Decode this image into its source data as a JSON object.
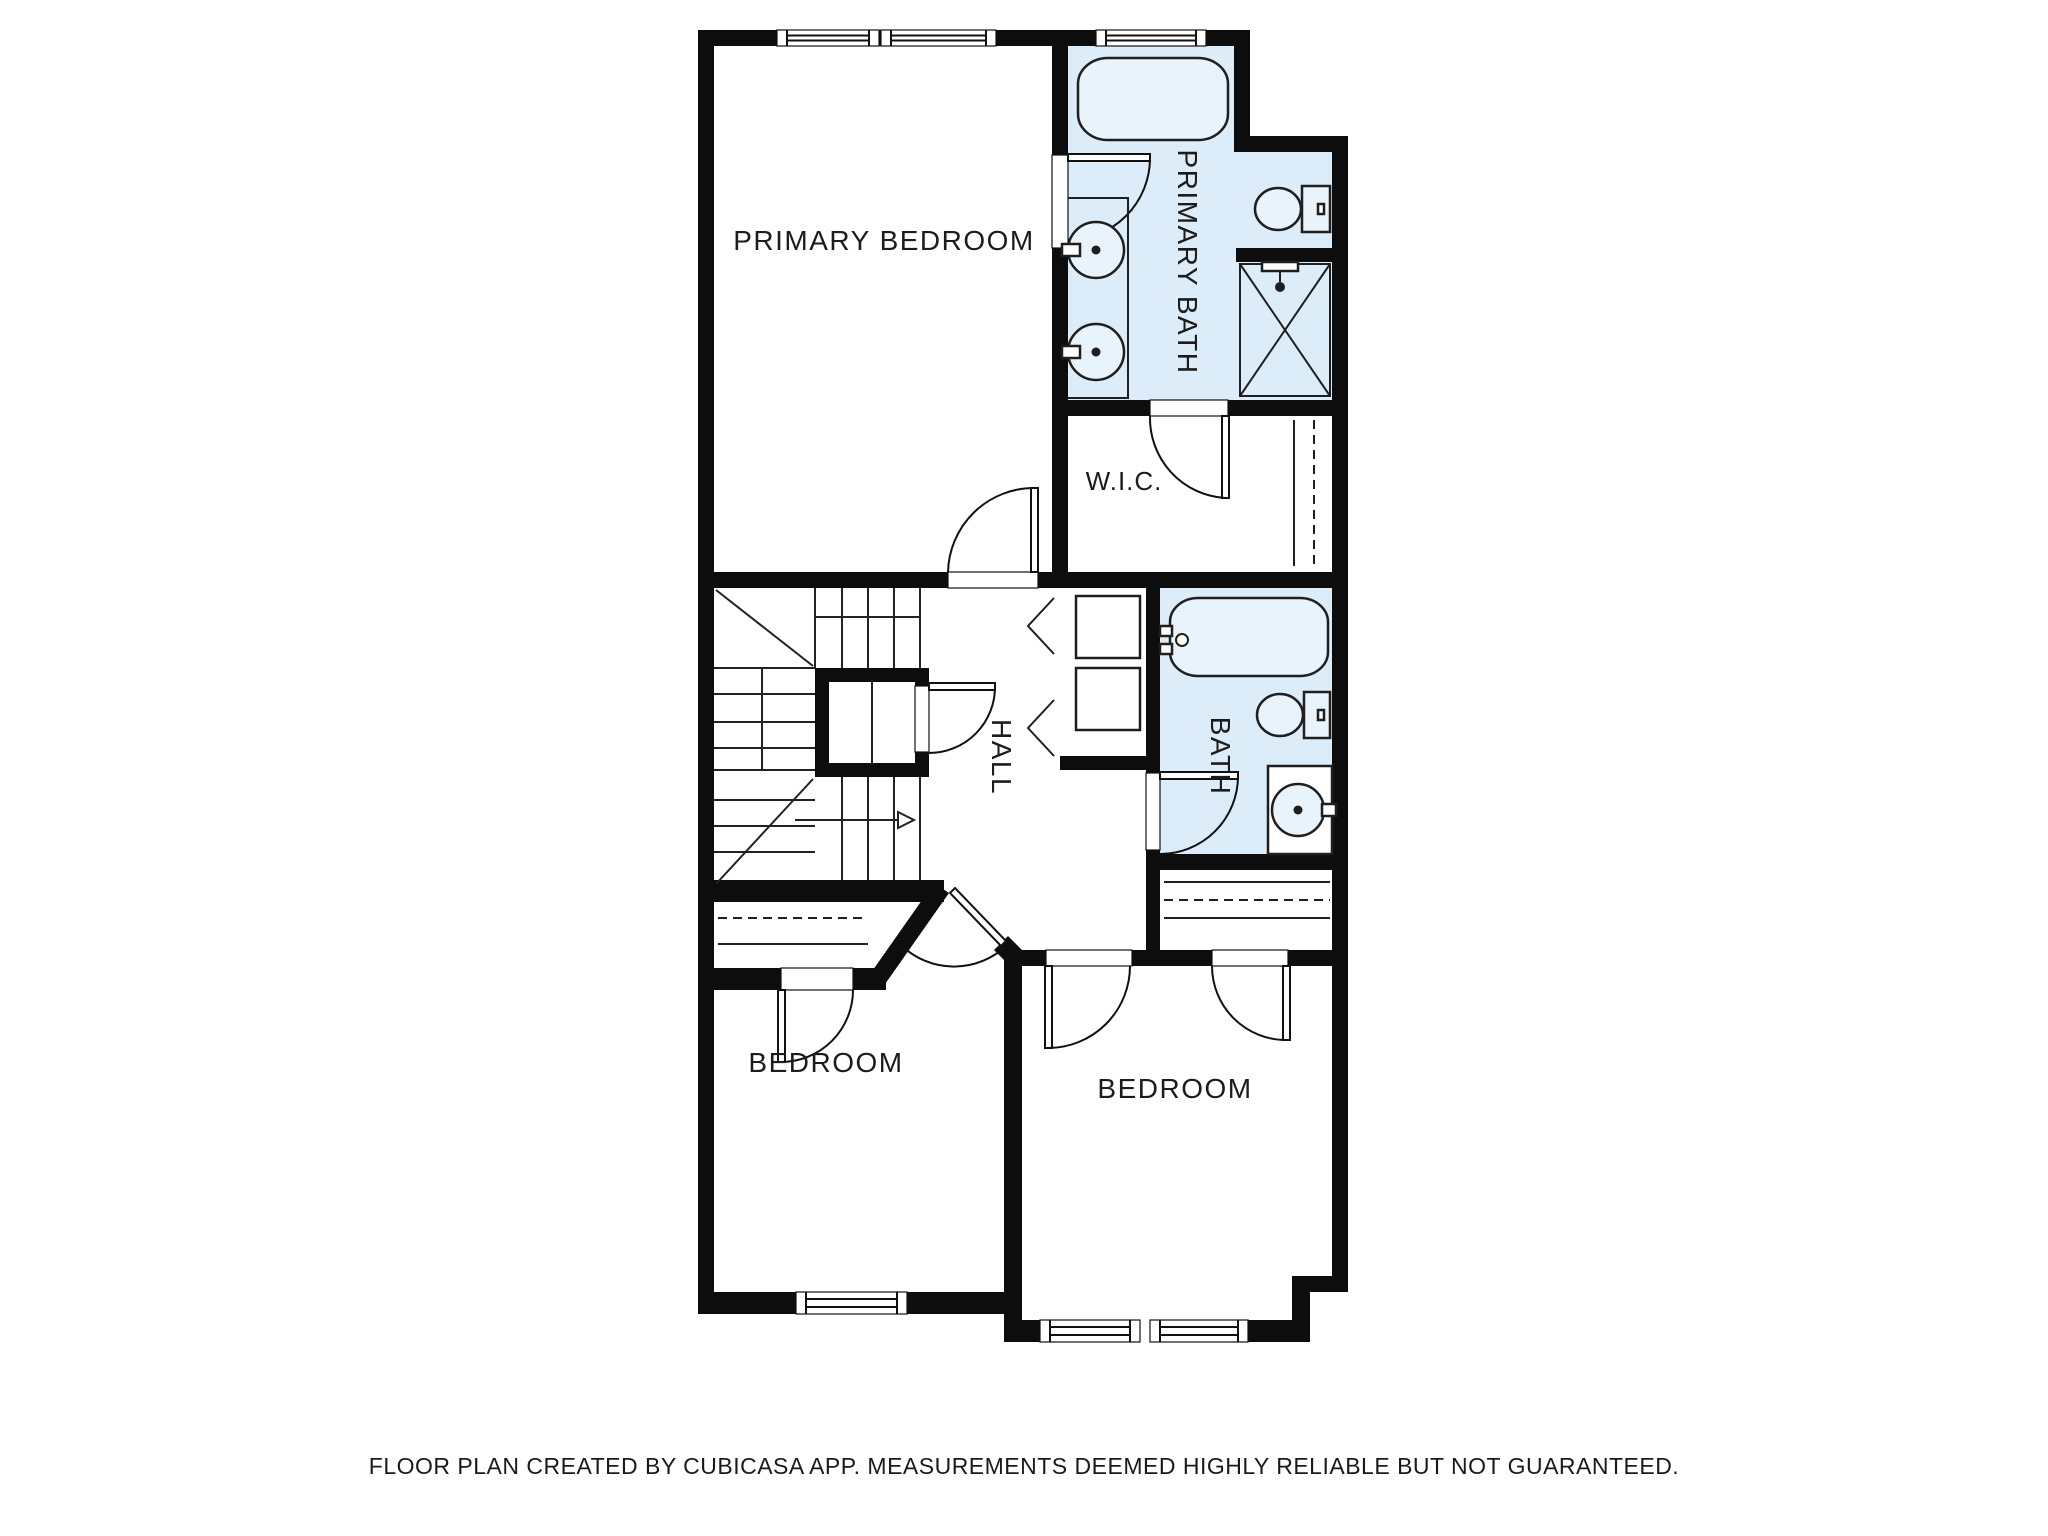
{
  "title": "Second floor plan",
  "creator_note": "CubiCasa floor plan",
  "colors": {
    "wall": "#0d0d0d",
    "bath_floor": "#dcecf8",
    "fixture_fill": "#e8f3fb",
    "line": "#1f1f1f",
    "background": "#ffffff"
  },
  "rooms": {
    "primary_bedroom": {
      "label": "PRIMARY BEDROOM"
    },
    "primary_bath": {
      "label": "PRIMARY BATH"
    },
    "wic": {
      "label": "W.I.C."
    },
    "hall": {
      "label": "HALL"
    },
    "bath": {
      "label": "BATH"
    },
    "bedroom_left": {
      "label": "BEDROOM"
    },
    "bedroom_right": {
      "label": "BEDROOM"
    }
  },
  "fixtures": [
    "bathtub-primary",
    "double-sink-vanity",
    "toilet-primary",
    "shower-stall",
    "bathtub-hall",
    "toilet-hall",
    "sink-vanity-hall",
    "washer",
    "dryer",
    "stairs-up-arrow",
    "closet-rods"
  ],
  "footer": {
    "disclaimer": "FLOOR PLAN CREATED BY CUBICASA APP. MEASUREMENTS DEEMED HIGHLY RELIABLE BUT NOT GUARANTEED."
  }
}
